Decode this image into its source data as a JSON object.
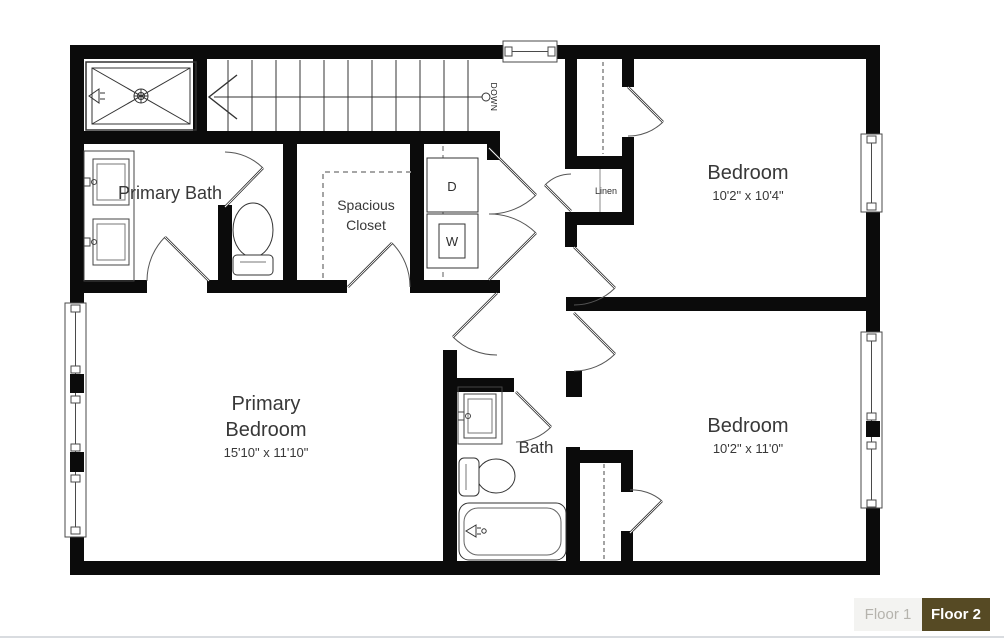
{
  "floor_plan": {
    "line_color": "#0b0b0b",
    "rooms": [
      {
        "name": "Primary Bath",
        "dims": ""
      },
      {
        "name": "Spacious Closet",
        "dims": ""
      },
      {
        "name": "Bedroom",
        "dims": "10'2\" x 10'4\""
      },
      {
        "name": "Primary Bedroom",
        "dims": "15'10\" x 11'10\""
      },
      {
        "name": "Bath",
        "dims": ""
      },
      {
        "name": "Bedroom",
        "dims": "10'2\" x 11'0\""
      }
    ],
    "annotations": {
      "down": "DOWN",
      "linen": "Linen",
      "dryer": "D",
      "washer": "W"
    }
  },
  "floor_selector": {
    "tabs": [
      {
        "label": "Floor 1",
        "active": false
      },
      {
        "label": "Floor 2",
        "active": true
      }
    ],
    "active_bg": "#564a24",
    "active_text": "#ffffff",
    "inactive_bg": "#f3f3f1",
    "inactive_text": "#b5b3ad"
  }
}
